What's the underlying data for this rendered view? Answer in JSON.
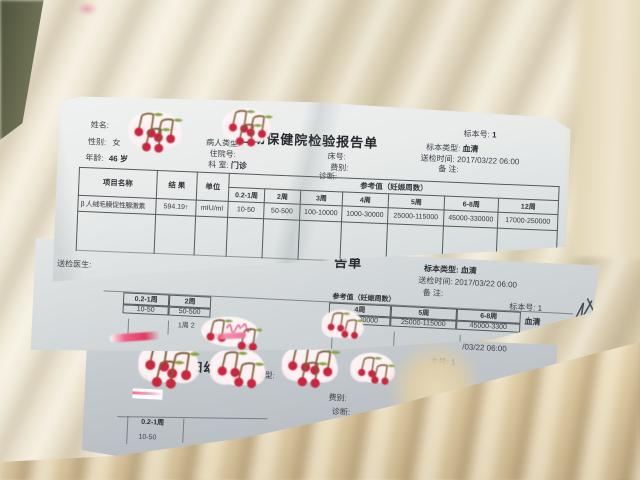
{
  "photo": {
    "background": "fluffy cream blanket",
    "paper_color": "#e8ebea",
    "cherry_red": "#c82740",
    "script_pink": "#e8639a",
    "ink": "#3c4148"
  },
  "decorations": {
    "sticker_icon": "cherry-sticker",
    "scribble_icon": "handwritten-scribble"
  },
  "sheet1": {
    "title": "妇幼保健院检验报告单",
    "name_label": "姓名:",
    "gender_label": "性别:",
    "gender_value": "女",
    "age_label": "年龄:",
    "age_value": "46 岁",
    "patient_type_label": "病人类型:",
    "admission_no_label": "住院号:",
    "dept_label": "科  室:",
    "dept_value": "门诊",
    "bed_no_label": "床号:",
    "fee_label": "费别:",
    "diagnosis_label": "诊断:",
    "sample_no_label": "标本号:",
    "sample_no_value": "1",
    "sample_type_label": "标本类型:",
    "sample_type_value": "血清",
    "send_time_label": "送检时间:",
    "send_time_value": "2017/03/22 06:00",
    "note_label": "备  注:",
    "table": {
      "item_header": "项目名称",
      "result_header": "结 果",
      "unit_header": "单位",
      "ref_header": "参考值（妊娠周数）",
      "weeks": [
        "0.2-1周",
        "2周",
        "3周",
        "4周",
        "5周",
        "6-8周",
        "12周"
      ],
      "row": {
        "item": "β 人绒毛膜促性腺激素",
        "result": "594.19↑",
        "unit": "mIU/ml",
        "refs": [
          "10-50",
          "50-500",
          "100-10000",
          "1000-30000",
          "25000-115000",
          "45000-330000",
          "17000-250000"
        ]
      }
    },
    "footer_label": "送检医生:"
  },
  "sheet2": {
    "title_fragment": "告单",
    "sample_no": "标本号: 1",
    "sample_type": "标本类型: 血清",
    "send_time": "送检时间: 2017/03/22 06:00",
    "note_label": "备  注:",
    "ref_header": "参考值（妊娠周数）",
    "weeks_left": [
      "0.2-1周",
      "2周"
    ],
    "values_left": [
      "10-50",
      "50-500"
    ],
    "weeks_right": [
      "4周",
      "5周",
      "6-8周"
    ],
    "values_right": [
      "1000-30000",
      "25000-115000",
      "45000-3300"
    ],
    "serum_fragment": "血清",
    "sample_no_right": "标本号: 1",
    "underlay_fragment": "1周   2"
  },
  "sheet3": {
    "type_fragment": "类型:",
    "title_fragment": "妇幼保健",
    "patient_type_fragment": "人类型:",
    "patient_type_label": "病人类型:",
    "title_end_fragment": "单",
    "fee_label": "费别:",
    "diagnosis_label": "诊断:",
    "week_fragment": "0.2-1周",
    "value_fragment": "10-50",
    "sample_no_fragment": "本号: 1",
    "time_fragment": "/03/22 06:00"
  }
}
